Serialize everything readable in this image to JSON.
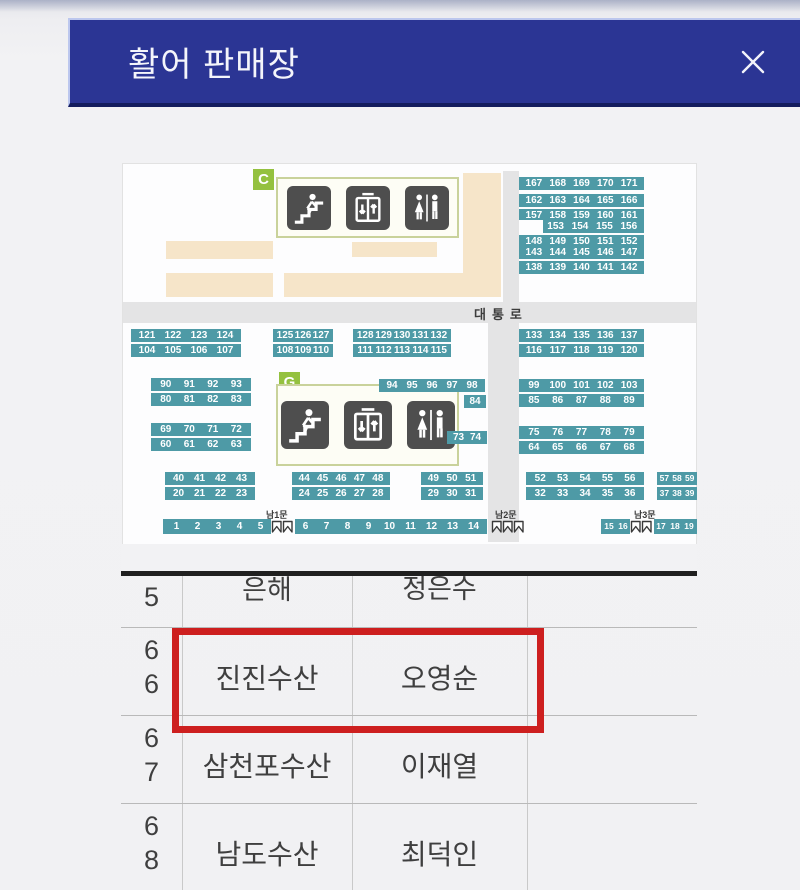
{
  "header": {
    "title": "활어 판매장",
    "close_glyph": "✕"
  },
  "map": {
    "section_labels": {
      "c": "C",
      "g": "G"
    },
    "road_label": "대통로",
    "gate_labels": {
      "south1": "남1문",
      "south2": "남2문",
      "south3": "남3문"
    },
    "legend_icons": [
      "stairs-icon",
      "elevator-icon",
      "restroom-icon"
    ],
    "colors": {
      "stall_teal": "#4e9aa6",
      "road_gray": "#e4e4e5",
      "block_beige": "#f6e5c9",
      "section_green": "#94c13f",
      "header_navy": "#2b3594",
      "highlight_red": "#cd1f1f"
    },
    "stalls": {
      "tr1": [
        [
          "167",
          "168",
          "169",
          "170",
          "171"
        ]
      ],
      "tr2": [
        [
          "162",
          "163",
          "164",
          "165",
          "166"
        ],
        [
          "157",
          "158",
          "159",
          "160",
          "161"
        ]
      ],
      "tr3": [
        [
          "",
          "153",
          "154",
          "155",
          "156"
        ],
        [
          "148",
          "149",
          "150",
          "151",
          "152"
        ]
      ],
      "tr4": [
        [
          "143",
          "144",
          "145",
          "146",
          "147"
        ],
        [
          "138",
          "139",
          "140",
          "141",
          "142"
        ]
      ],
      "m1": [
        [
          "121",
          "122",
          "123",
          "124"
        ],
        [
          "104",
          "105",
          "106",
          "107"
        ]
      ],
      "m2": [
        [
          "125",
          "126",
          "127"
        ],
        [
          "108",
          "109",
          "110"
        ]
      ],
      "m3": [
        [
          "128",
          "129",
          "130",
          "131",
          "132"
        ],
        [
          "111",
          "112",
          "113",
          "114",
          "115"
        ]
      ],
      "m4": [
        [
          "133",
          "134",
          "135",
          "136",
          "137"
        ],
        [
          "116",
          "117",
          "118",
          "119",
          "120"
        ]
      ],
      "g1": [
        [
          "90",
          "91",
          "92",
          "93"
        ],
        [
          "80",
          "81",
          "82",
          "83"
        ]
      ],
      "g2": [
        [
          "69",
          "70",
          "71",
          "72"
        ],
        [
          "60",
          "61",
          "62",
          "63"
        ]
      ],
      "strip94": [
        [
          "94",
          "95",
          "96",
          "97",
          "98"
        ]
      ],
      "s84": [
        [
          "84"
        ]
      ],
      "s7374": [
        [
          "73",
          "74"
        ]
      ],
      "r1": [
        [
          "99",
          "100",
          "101",
          "102",
          "103"
        ],
        [
          "85",
          "86",
          "87",
          "88",
          "89"
        ]
      ],
      "r2": [
        [
          "75",
          "76",
          "77",
          "78",
          "79"
        ],
        [
          "64",
          "65",
          "66",
          "67",
          "68"
        ]
      ],
      "b1": [
        [
          "40",
          "41",
          "42",
          "43"
        ],
        [
          "20",
          "21",
          "22",
          "23"
        ]
      ],
      "b2": [
        [
          "44",
          "45",
          "46",
          "47",
          "48"
        ],
        [
          "24",
          "25",
          "26",
          "27",
          "28"
        ]
      ],
      "b3": [
        [
          "49",
          "50",
          "51"
        ],
        [
          "29",
          "30",
          "31"
        ]
      ],
      "b4": [
        [
          "52",
          "53",
          "54",
          "55",
          "56"
        ],
        [
          "32",
          "33",
          "34",
          "35",
          "36"
        ]
      ],
      "b5": [
        [
          "57",
          "58",
          "59"
        ],
        [
          "37",
          "38",
          "39"
        ]
      ],
      "bar1": [
        [
          "1",
          "2",
          "3",
          "4",
          "5",
          "G2",
          "6",
          "7",
          "8",
          "9",
          "10",
          "11",
          "12",
          "13",
          "14"
        ]
      ],
      "bar2": [
        [
          "15",
          "16",
          "G2",
          "17",
          "18",
          "19"
        ]
      ]
    }
  },
  "table": {
    "rows": [
      {
        "no_top": "6",
        "no_bottom": "5",
        "shop": "은해",
        "owner": "정은수"
      },
      {
        "no_top": "6",
        "no_bottom": "6",
        "shop": "진진수산",
        "owner": "오영순",
        "highlighted": true
      },
      {
        "no_top": "6",
        "no_bottom": "7",
        "shop": "삼천포수산",
        "owner": "이재열"
      },
      {
        "no_top": "6",
        "no_bottom": "8",
        "shop": "남도수산",
        "owner": "최덕인"
      }
    ]
  }
}
